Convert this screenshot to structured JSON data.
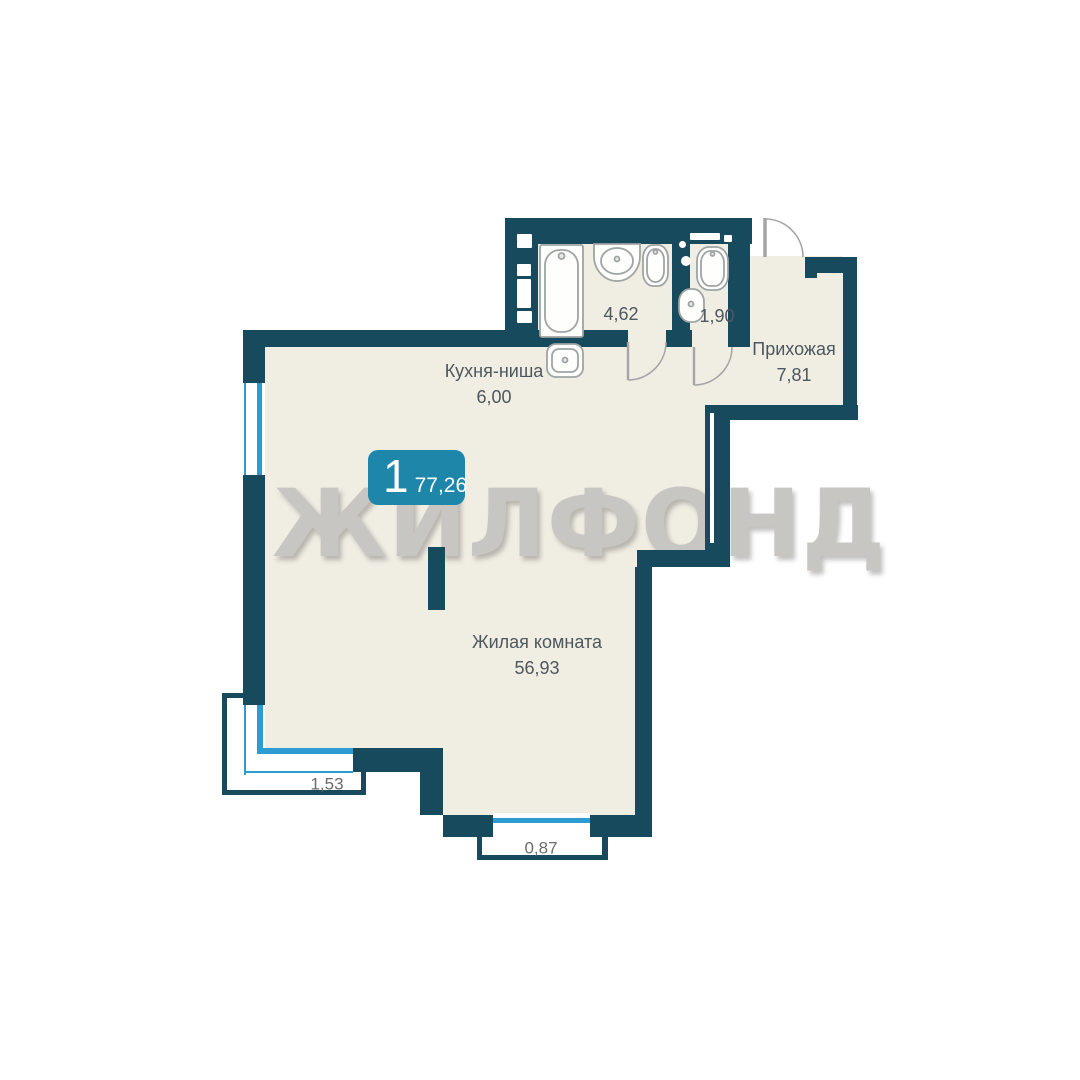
{
  "plan": {
    "watermark": "ЖИЛФОНД",
    "badge": {
      "rooms_count": "1",
      "total_area": "77,26"
    },
    "rooms": [
      {
        "key": "kitchen",
        "name": "Кухня-ниша",
        "area": "6,00"
      },
      {
        "key": "living",
        "name": "Жилая комната",
        "area": "56,93"
      },
      {
        "key": "hallway",
        "name": "Прихожая",
        "area": "7,81"
      },
      {
        "key": "bathroom",
        "area": "4,62"
      },
      {
        "key": "wc",
        "area": "1,90"
      }
    ],
    "balcony_dimensions": [
      "1,53",
      "0,87"
    ],
    "colors": {
      "wall": "#184A5D",
      "floor": "#F0EDE3",
      "window": "#2C9CD3",
      "badge": "#1E87A9",
      "watermark": "#C8C6C2"
    }
  }
}
